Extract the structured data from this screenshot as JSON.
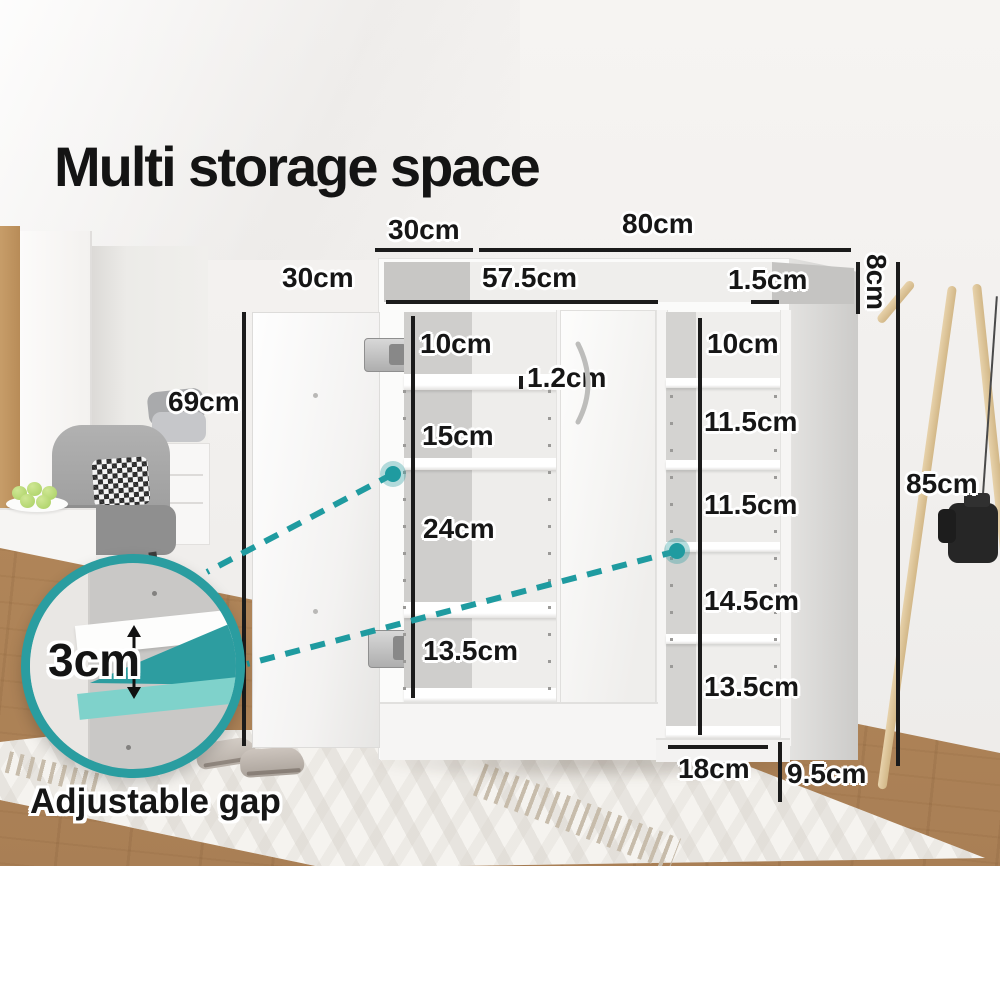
{
  "title": "Multi storage space",
  "colors": {
    "accent_teal": "#2a9da0",
    "accent_teal_light": "#7fd2cb",
    "dimension_text": "#161616"
  },
  "dimensions": {
    "top_depth": "30cm",
    "total_width": "80cm",
    "inner_width": "57.5cm",
    "edge_thickness": "1.5cm",
    "top_section_height": "8cm",
    "left_door_width": "30cm",
    "left_door_height": "69cm",
    "total_height": "85cm",
    "shelf_thickness": "1.2cm",
    "middle_gaps": [
      "10cm",
      "15cm",
      "24cm",
      "13.5cm"
    ],
    "right_gaps": [
      "10cm",
      "11.5cm",
      "11.5cm",
      "14.5cm",
      "13.5cm"
    ],
    "base_depth": "18cm",
    "base_height": "9.5cm"
  },
  "callout": {
    "gap_value": "3cm",
    "gap_caption": "Adjustable gap"
  }
}
